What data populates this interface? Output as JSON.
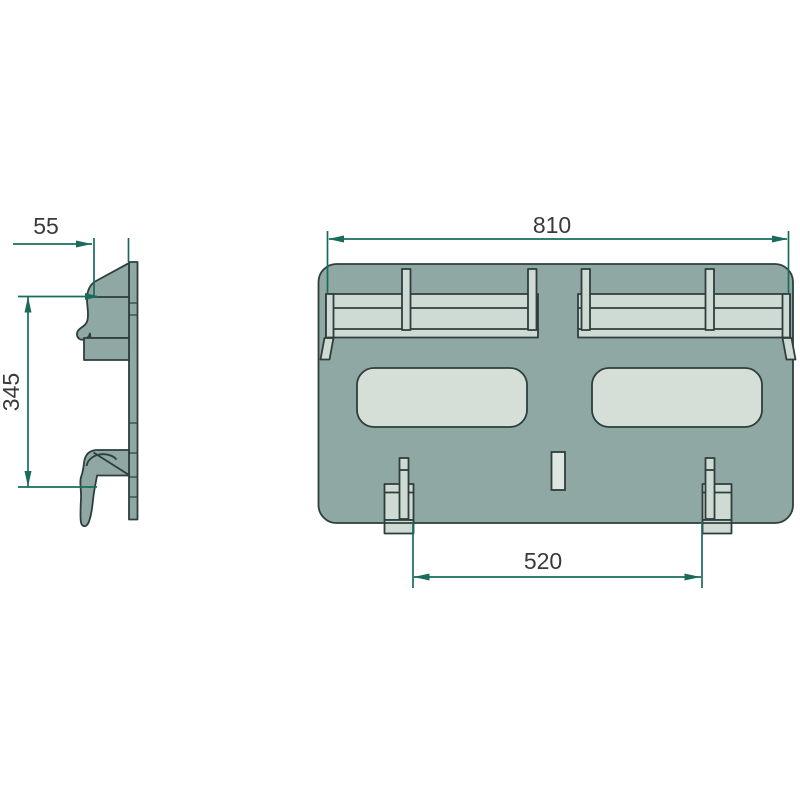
{
  "dimensions": {
    "side_depth": {
      "label": "55"
    },
    "side_height": {
      "label": "345"
    },
    "front_width": {
      "label": "810"
    },
    "bracket_spacing": {
      "label": "520"
    }
  },
  "colors": {
    "part_fill": "#90a8a3",
    "part_light": "#cedad3",
    "window_fill": "#d5dfd8",
    "slot_fill": "#dee6e0",
    "outline": "#2d3e3c",
    "dimension": "#1a6b5d",
    "text": "#3a3a3a"
  }
}
